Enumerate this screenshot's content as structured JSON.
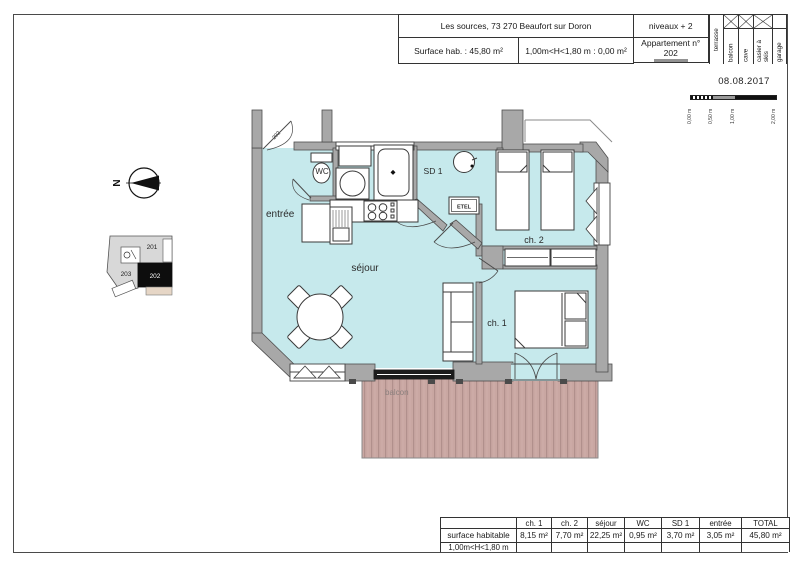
{
  "header": {
    "project": "Les sources, 73 270 Beaufort sur Doron",
    "niveaux": "niveaux + 2",
    "surface_hab": "Surface hab. :  45,80 m²",
    "height_note": "1,00m<H<1,80 m : 0,00 m²",
    "apartment": "Appartement n° 202",
    "date": "08.08.2017",
    "columns": [
      {
        "label": "terrasse",
        "checked": false
      },
      {
        "label": "balcon",
        "checked": true
      },
      {
        "label": "cave",
        "checked": true
      },
      {
        "label": "casier à skis",
        "checked": true
      },
      {
        "label": "garage",
        "checked": false
      }
    ]
  },
  "scale_bar": {
    "labels": [
      "0,00 m",
      "0,50 m",
      "1,00 m",
      "2,00 m"
    ]
  },
  "north": {
    "label": "N"
  },
  "key_plan": {
    "unit_201": "201",
    "unit_202": "202",
    "unit_203": "203"
  },
  "plan": {
    "rooms": {
      "entree": "entrée",
      "sejour": "séjour",
      "wc": "WC",
      "sd1": "SD 1",
      "ch1": "ch. 1",
      "ch2": "ch. 2",
      "etel": "ETEL",
      "balcon": "balcon",
      "door_label": "202"
    }
  },
  "summary_table": {
    "col_headers": [
      "",
      "ch. 1",
      "ch. 2",
      "séjour",
      "WC",
      "SD 1",
      "entrée",
      "TOTAL"
    ],
    "rows": [
      {
        "label": "surface habitable",
        "values": [
          "8,15 m²",
          "7,70 m²",
          "22,25 m²",
          "0,95 m²",
          "3,70 m²",
          "3,05 m²",
          "45,80 m²"
        ]
      },
      {
        "label": "1,00m<H<1,80 m",
        "values": [
          "",
          "",
          "",
          "",
          "",
          "",
          ""
        ]
      }
    ]
  },
  "colors": {
    "floor": "#c6e9ec",
    "wall": "#a8a8a8",
    "deck": "#c9a7a2",
    "accent_black": "#0d0d0d"
  }
}
